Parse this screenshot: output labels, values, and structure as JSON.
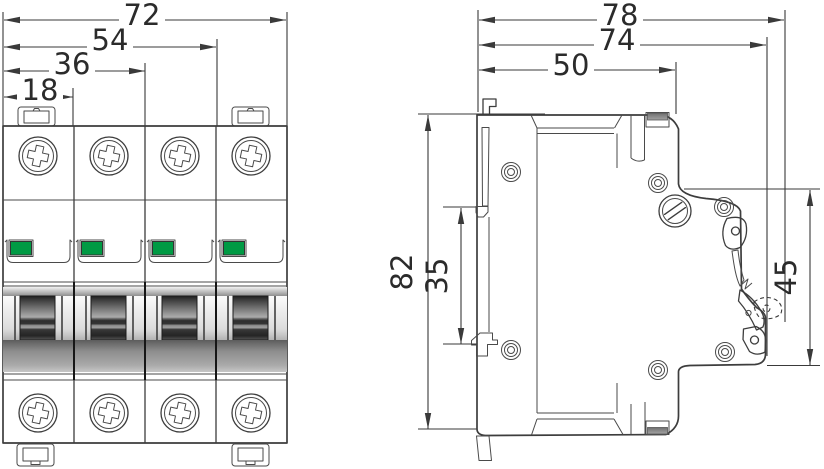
{
  "drawing": {
    "type": "technical dimensional drawing",
    "subject": "4-pole DIN-rail miniature circuit breaker",
    "views": {
      "front_label": "front view",
      "side_label": "side view"
    }
  },
  "front_view": {
    "poles": 4,
    "dims": {
      "overall": "72",
      "three_modules": "54",
      "two_modules": "36",
      "one_module": "18"
    }
  },
  "side_view": {
    "dims": {
      "total_depth": "78",
      "body_depth": "74",
      "front_depth": "50",
      "height": "82",
      "rail_slot": "35",
      "front_face": "45"
    }
  },
  "colors": {
    "indicator_green": "#009a44",
    "line": "#3d3d3d",
    "dim_line": "#3a3a3a",
    "handle_dark": "#2a2a2a",
    "metal_gray": "#8f8f8f"
  }
}
